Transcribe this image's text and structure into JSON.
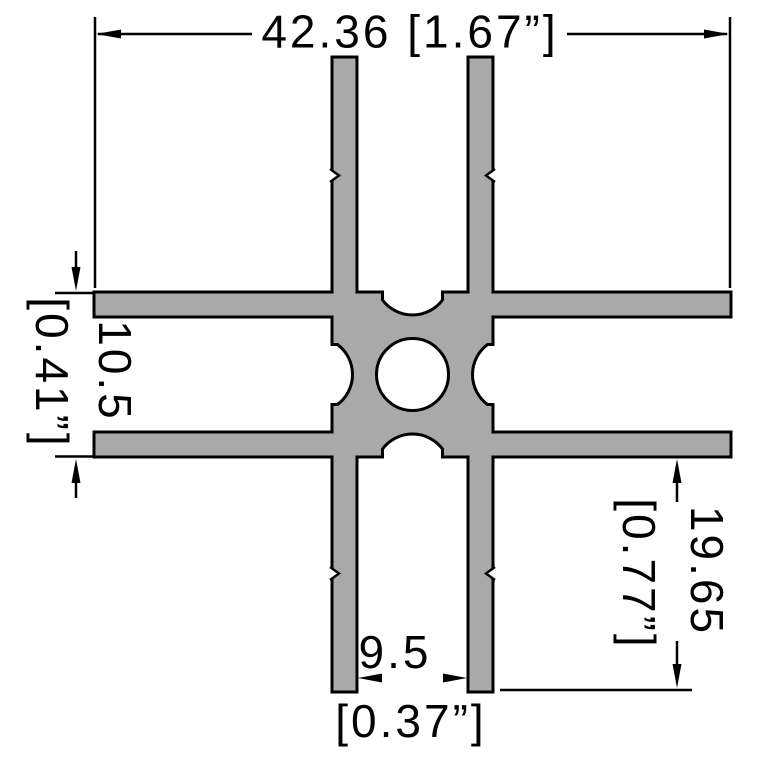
{
  "colors": {
    "background": "#ffffff",
    "profile_fill": "#a9a9a9",
    "line": "#000000"
  },
  "dimensions": {
    "overall_width": {
      "label": "42.36 [1.67”]",
      "mm": "42.36",
      "inch": "[1.67”]"
    },
    "channel_height": {
      "mm": "10.5",
      "inch": "[0.41”]"
    },
    "leg_depth": {
      "mm": "19.65",
      "inch": "[0.77”]"
    },
    "slot_gap": {
      "mm": "9.5",
      "inch": "[0.37”]"
    }
  }
}
